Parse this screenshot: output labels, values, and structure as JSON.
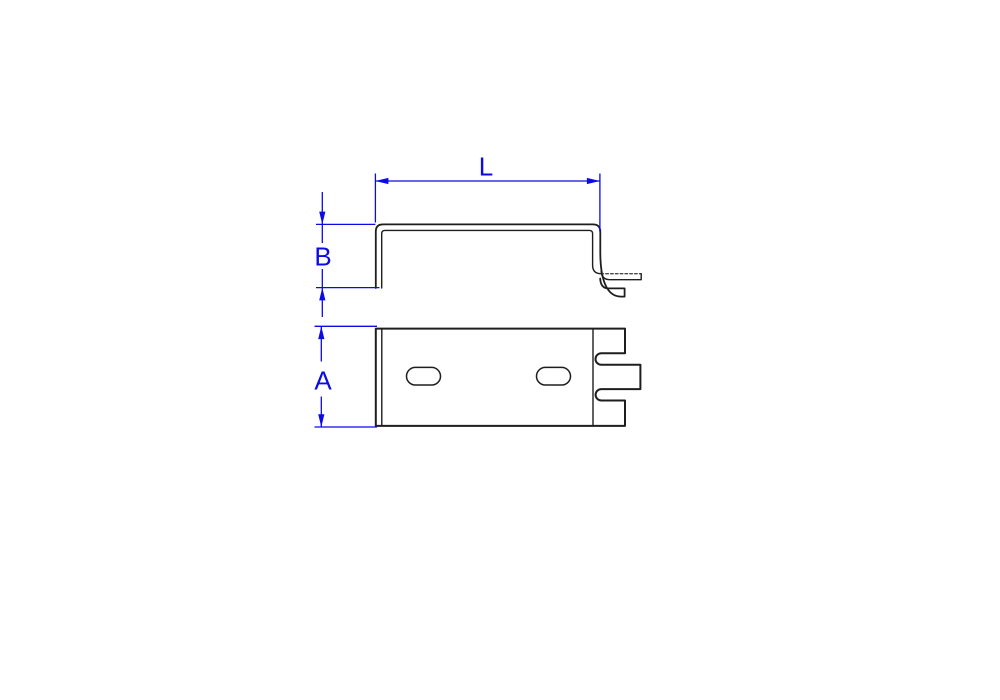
{
  "drawing": {
    "dimensions": {
      "length": {
        "label": "L"
      },
      "flange_height": {
        "label": "B"
      },
      "body_height": {
        "label": "A"
      }
    },
    "colors": {
      "dimension": "#0b0be6",
      "part_line": "#1e1e1e",
      "tangent_line": "#4a4a4a",
      "background": "#ffffff"
    }
  }
}
